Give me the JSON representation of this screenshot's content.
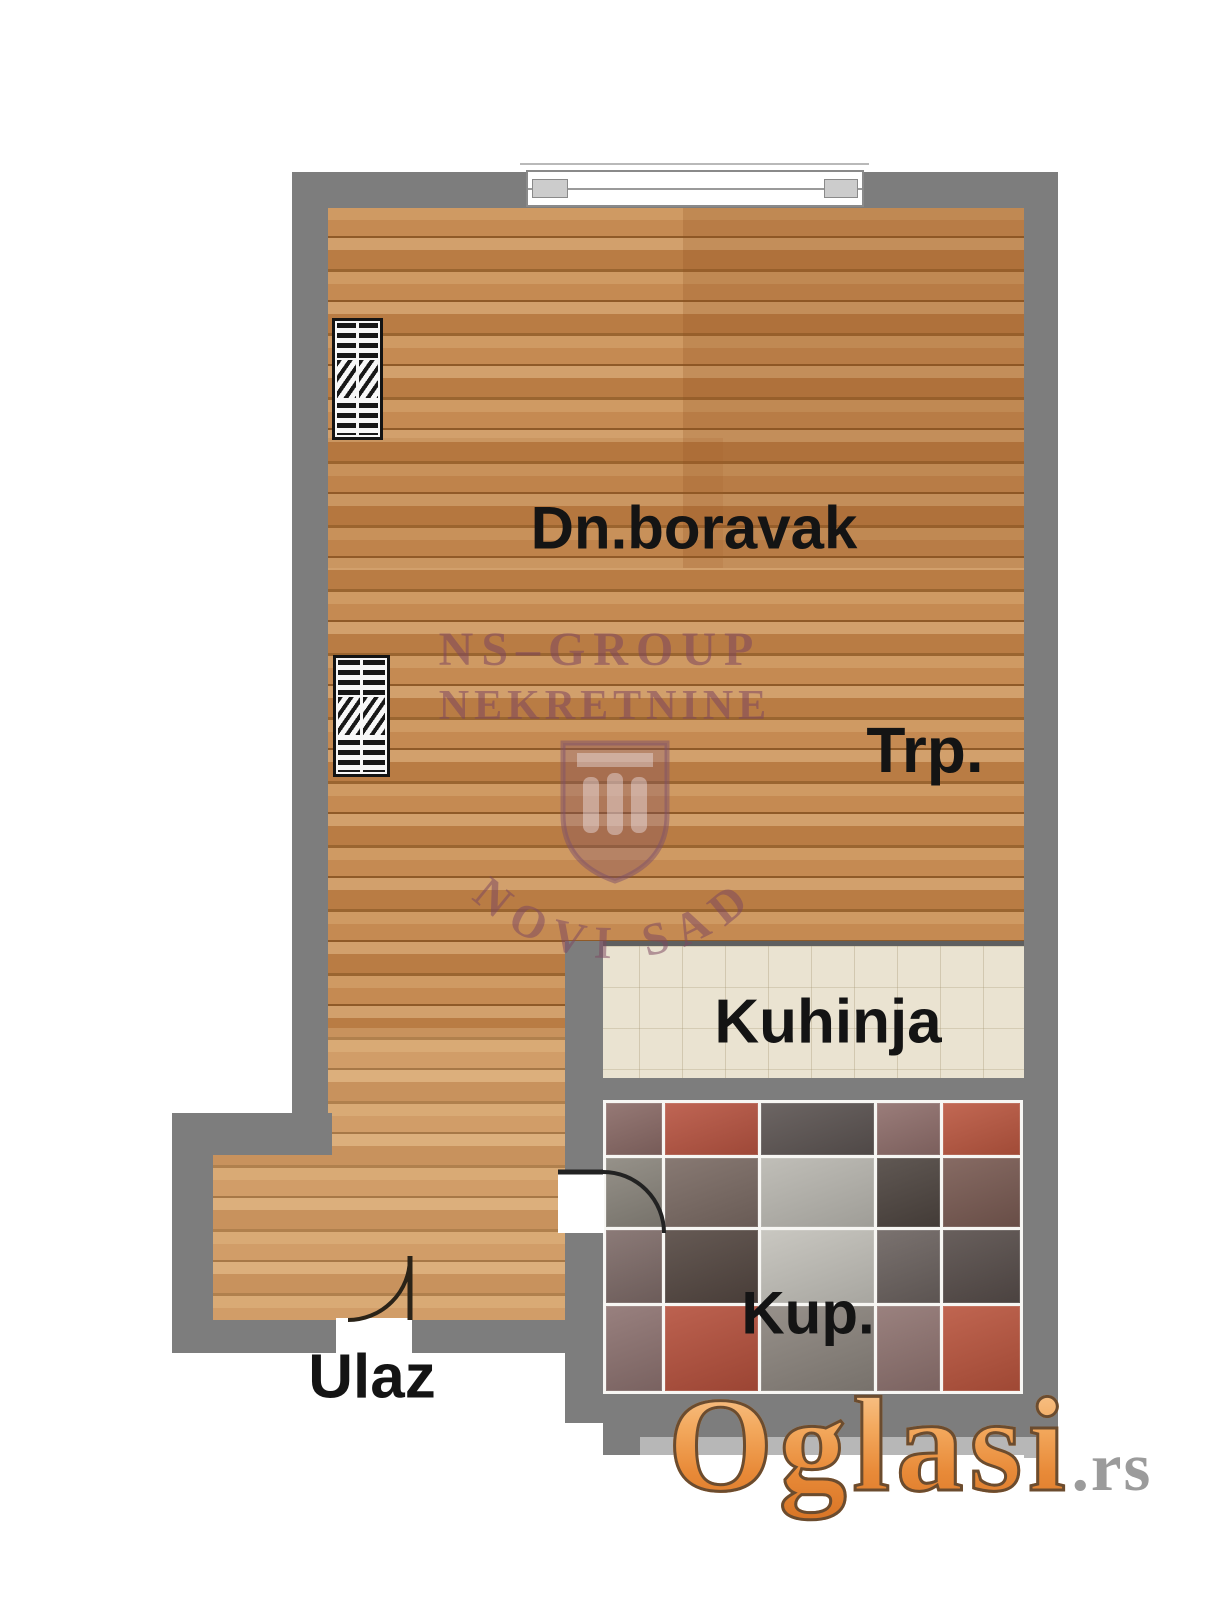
{
  "plan": {
    "type": "apartment-floor-plan",
    "rooms": {
      "living": "Dn.boravak",
      "dining": "Trp.",
      "kitchen": "Kuhinja",
      "bath": "Kup."
    },
    "entrance": "Ulaz"
  },
  "watermark": {
    "line1": "NS–GROUP",
    "line2": "NEKRETNINE",
    "arc": "NOVI SAD"
  },
  "logo": {
    "name": "Oglasi",
    "tld": ".rs"
  },
  "colors": {
    "wall": "#7d7d7d",
    "wood_base": "#c4854f",
    "kitchen_floor": "#eae3d1",
    "tile_grout": "#f7f6f3",
    "label_text": "#141414",
    "watermark": "#7d4660",
    "logo_orange": "#e88a38",
    "logo_tld_gray": "#9b9b9b"
  },
  "bathroom": {
    "tiles": [
      [
        "#8a6a66",
        "#b85441",
        "#5c5452",
        "#8f6e6b",
        "#bb5740"
      ],
      [
        "#8a857c",
        "#7a6a63",
        "#b9b7b0",
        "#4e4540",
        "#795a52"
      ],
      [
        "#7e6b68",
        "#544741",
        "#c3c1ba",
        "#6b625f",
        "#574d4a"
      ],
      [
        "#8d7270",
        "#b5503c",
        "#8b847d",
        "#8f7370",
        "#b9543d"
      ]
    ]
  }
}
